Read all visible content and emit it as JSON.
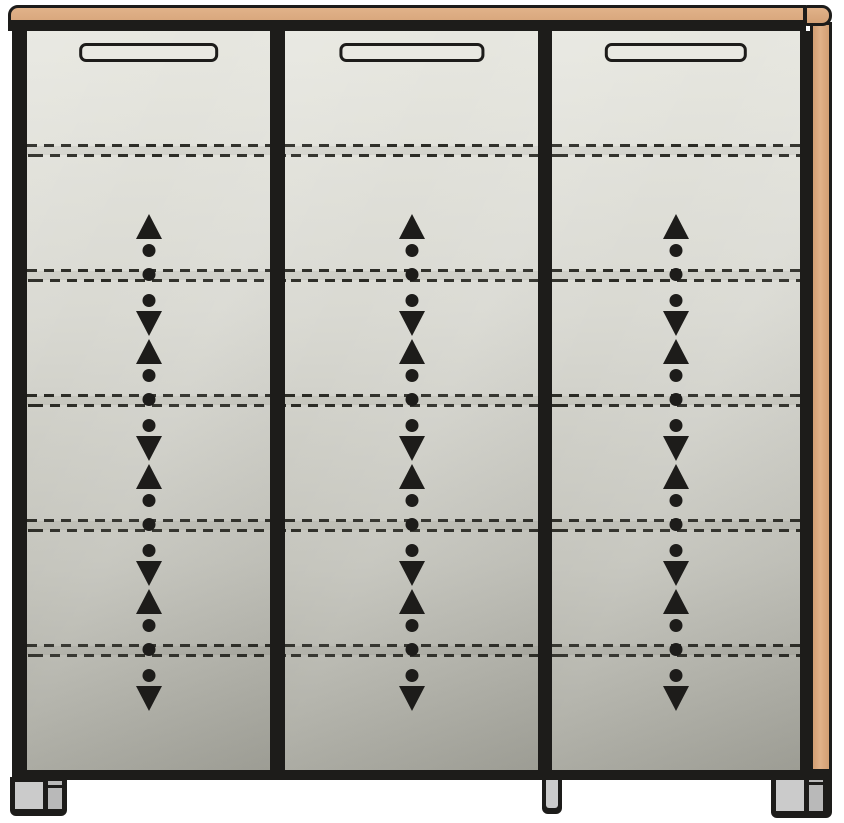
{
  "cabinet": {
    "kind": "furniture-front-elevation-diagram",
    "description": "Three-door cabinet with wood top board, right wood side panel, recessed horizontal handles, dashed shelf-position lines and height-adjustable shelf arrow indicators, standing on feet",
    "colors": {
      "background": "#ffffff",
      "outline": "#1d1c1a",
      "wood": "#d4a176",
      "wood_light": "#e1b289",
      "panel_light": "#e7e7e0",
      "panel_dark": "#a5a59c",
      "handle_fill": "#e9e9e2",
      "foot_light": "#cbcbcb",
      "foot_dark": "#b9b9b9",
      "line_color": "#2a2a24"
    },
    "top_board": {
      "left_end": "rounded",
      "right_end_cap": true
    },
    "side_panel_position": "right",
    "doors": [
      {
        "id": "left",
        "x": 15,
        "width": 243,
        "handle": "recessed-horizontal"
      },
      {
        "id": "center",
        "x": 273,
        "width": 253,
        "handle": "recessed-horizontal"
      },
      {
        "id": "right",
        "x": 540,
        "width": 248,
        "handle": "recessed-horizontal"
      }
    ],
    "shelf_lines_y": [
      119,
      244,
      369,
      494,
      619
    ],
    "adjustable_shelves_y": [
      244,
      369,
      494,
      619
    ],
    "adjustable_shelf_indicator": {
      "up_arrow": 1,
      "dots": 3,
      "down_arrow": 1
    },
    "feet": [
      {
        "id": "left",
        "x": 10,
        "y": 777,
        "width": 57,
        "height": 39,
        "style": "two-tone"
      },
      {
        "id": "center",
        "x": 542,
        "y": 777,
        "width": 20,
        "height": 37,
        "style": "slim"
      },
      {
        "id": "right",
        "x": 771,
        "y": 774,
        "width": 61,
        "height": 44,
        "style": "two-tone"
      }
    ]
  }
}
